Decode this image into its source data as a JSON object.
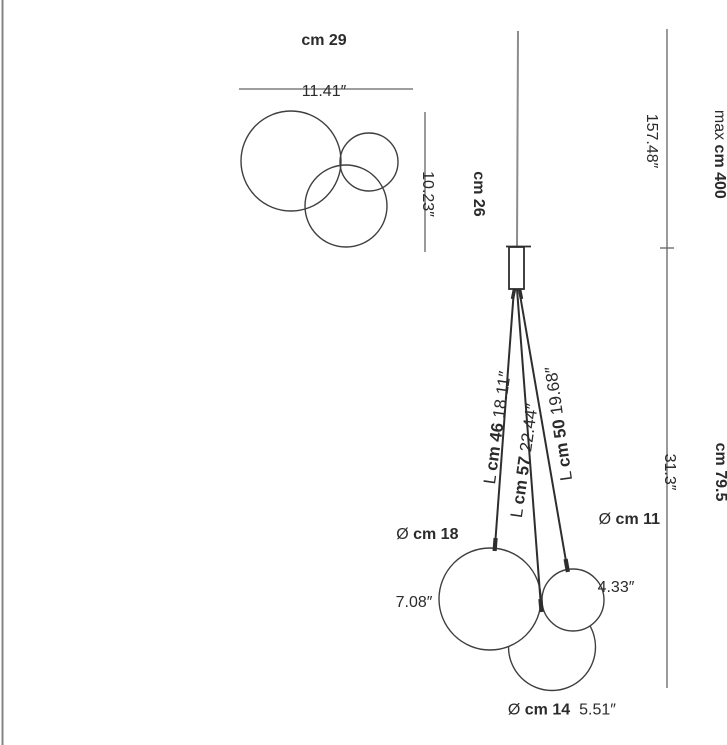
{
  "colors": {
    "background": "#ffffff",
    "outline": "#3f3f3f",
    "fixture_line": "#2e2e2e",
    "suspension_cable": "#8c8c8c",
    "dimension_line": "#636363",
    "page_border": "#848484",
    "text": "#2b2b2b"
  },
  "top_view": {
    "width": {
      "value": "cm 29",
      "inches": "11.41″"
    },
    "depth": {
      "value": "cm 26",
      "inches": "10.23″"
    }
  },
  "front_view": {
    "max_height": {
      "prefix": "max ",
      "value": "cm 400",
      "inches": "157.48″"
    },
    "fixture_height": {
      "value": "cm 79.5",
      "inches": "31.3″"
    },
    "cables": [
      {
        "prefix": "L ",
        "value": "cm 46",
        "inches": " 18.11″"
      },
      {
        "prefix": "L ",
        "value": "cm 57",
        "inches": " 22.44″"
      },
      {
        "prefix": "L ",
        "value": "cm 50",
        "inches": " 19.68″"
      }
    ],
    "spheres": [
      {
        "prefix": "Ø ",
        "value": "cm 18",
        "inches": "7.08″"
      },
      {
        "prefix": "Ø ",
        "value": "cm 11",
        "inches": "4.33″"
      },
      {
        "prefix": "Ø ",
        "value": "cm 14",
        "inches": "5.51″"
      }
    ]
  }
}
